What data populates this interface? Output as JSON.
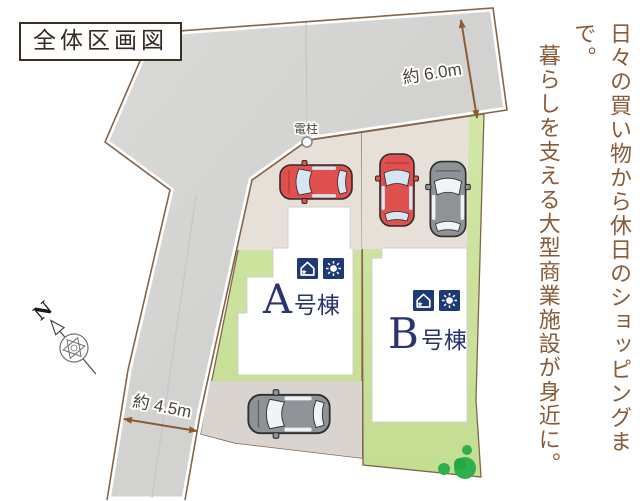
{
  "title_box": {
    "label": "全体区画図"
  },
  "caption": {
    "line1": "日々の買い物から休日のショッピングまで。",
    "line2": "暮らしを支える大型商業施設が身近に。"
  },
  "dimensions": {
    "road_top_width": "約 6.0m",
    "road_left_width": "約 4.5m"
  },
  "utility_pole": {
    "label": "電柱"
  },
  "compass": {
    "label": "N"
  },
  "buildings": [
    {
      "id": "A",
      "letter": "A",
      "suffix": "号棟",
      "icons": [
        "house-icon",
        "sun-icon"
      ]
    },
    {
      "id": "B",
      "letter": "B",
      "suffix": "号棟",
      "icons": [
        "house-icon",
        "sun-icon"
      ]
    }
  ],
  "icons": {
    "star_glyph": "★"
  },
  "palette": {
    "road_gray": "#d6d5d3",
    "boundary_brown": "#85644a",
    "parking_beige": "#e6e0d8",
    "parking_gray": "#d9d4cf",
    "lawn_green": "#cde49e",
    "bush_green": "#2db04d",
    "building_white": "#ffffff",
    "icon_navy": "#1e3a76",
    "label_navy": "#2b3470",
    "car_red": "#e0504e",
    "car_gray": "#909599",
    "dimension_text": "#4e453c",
    "caption_brown": "#8a5b38"
  }
}
